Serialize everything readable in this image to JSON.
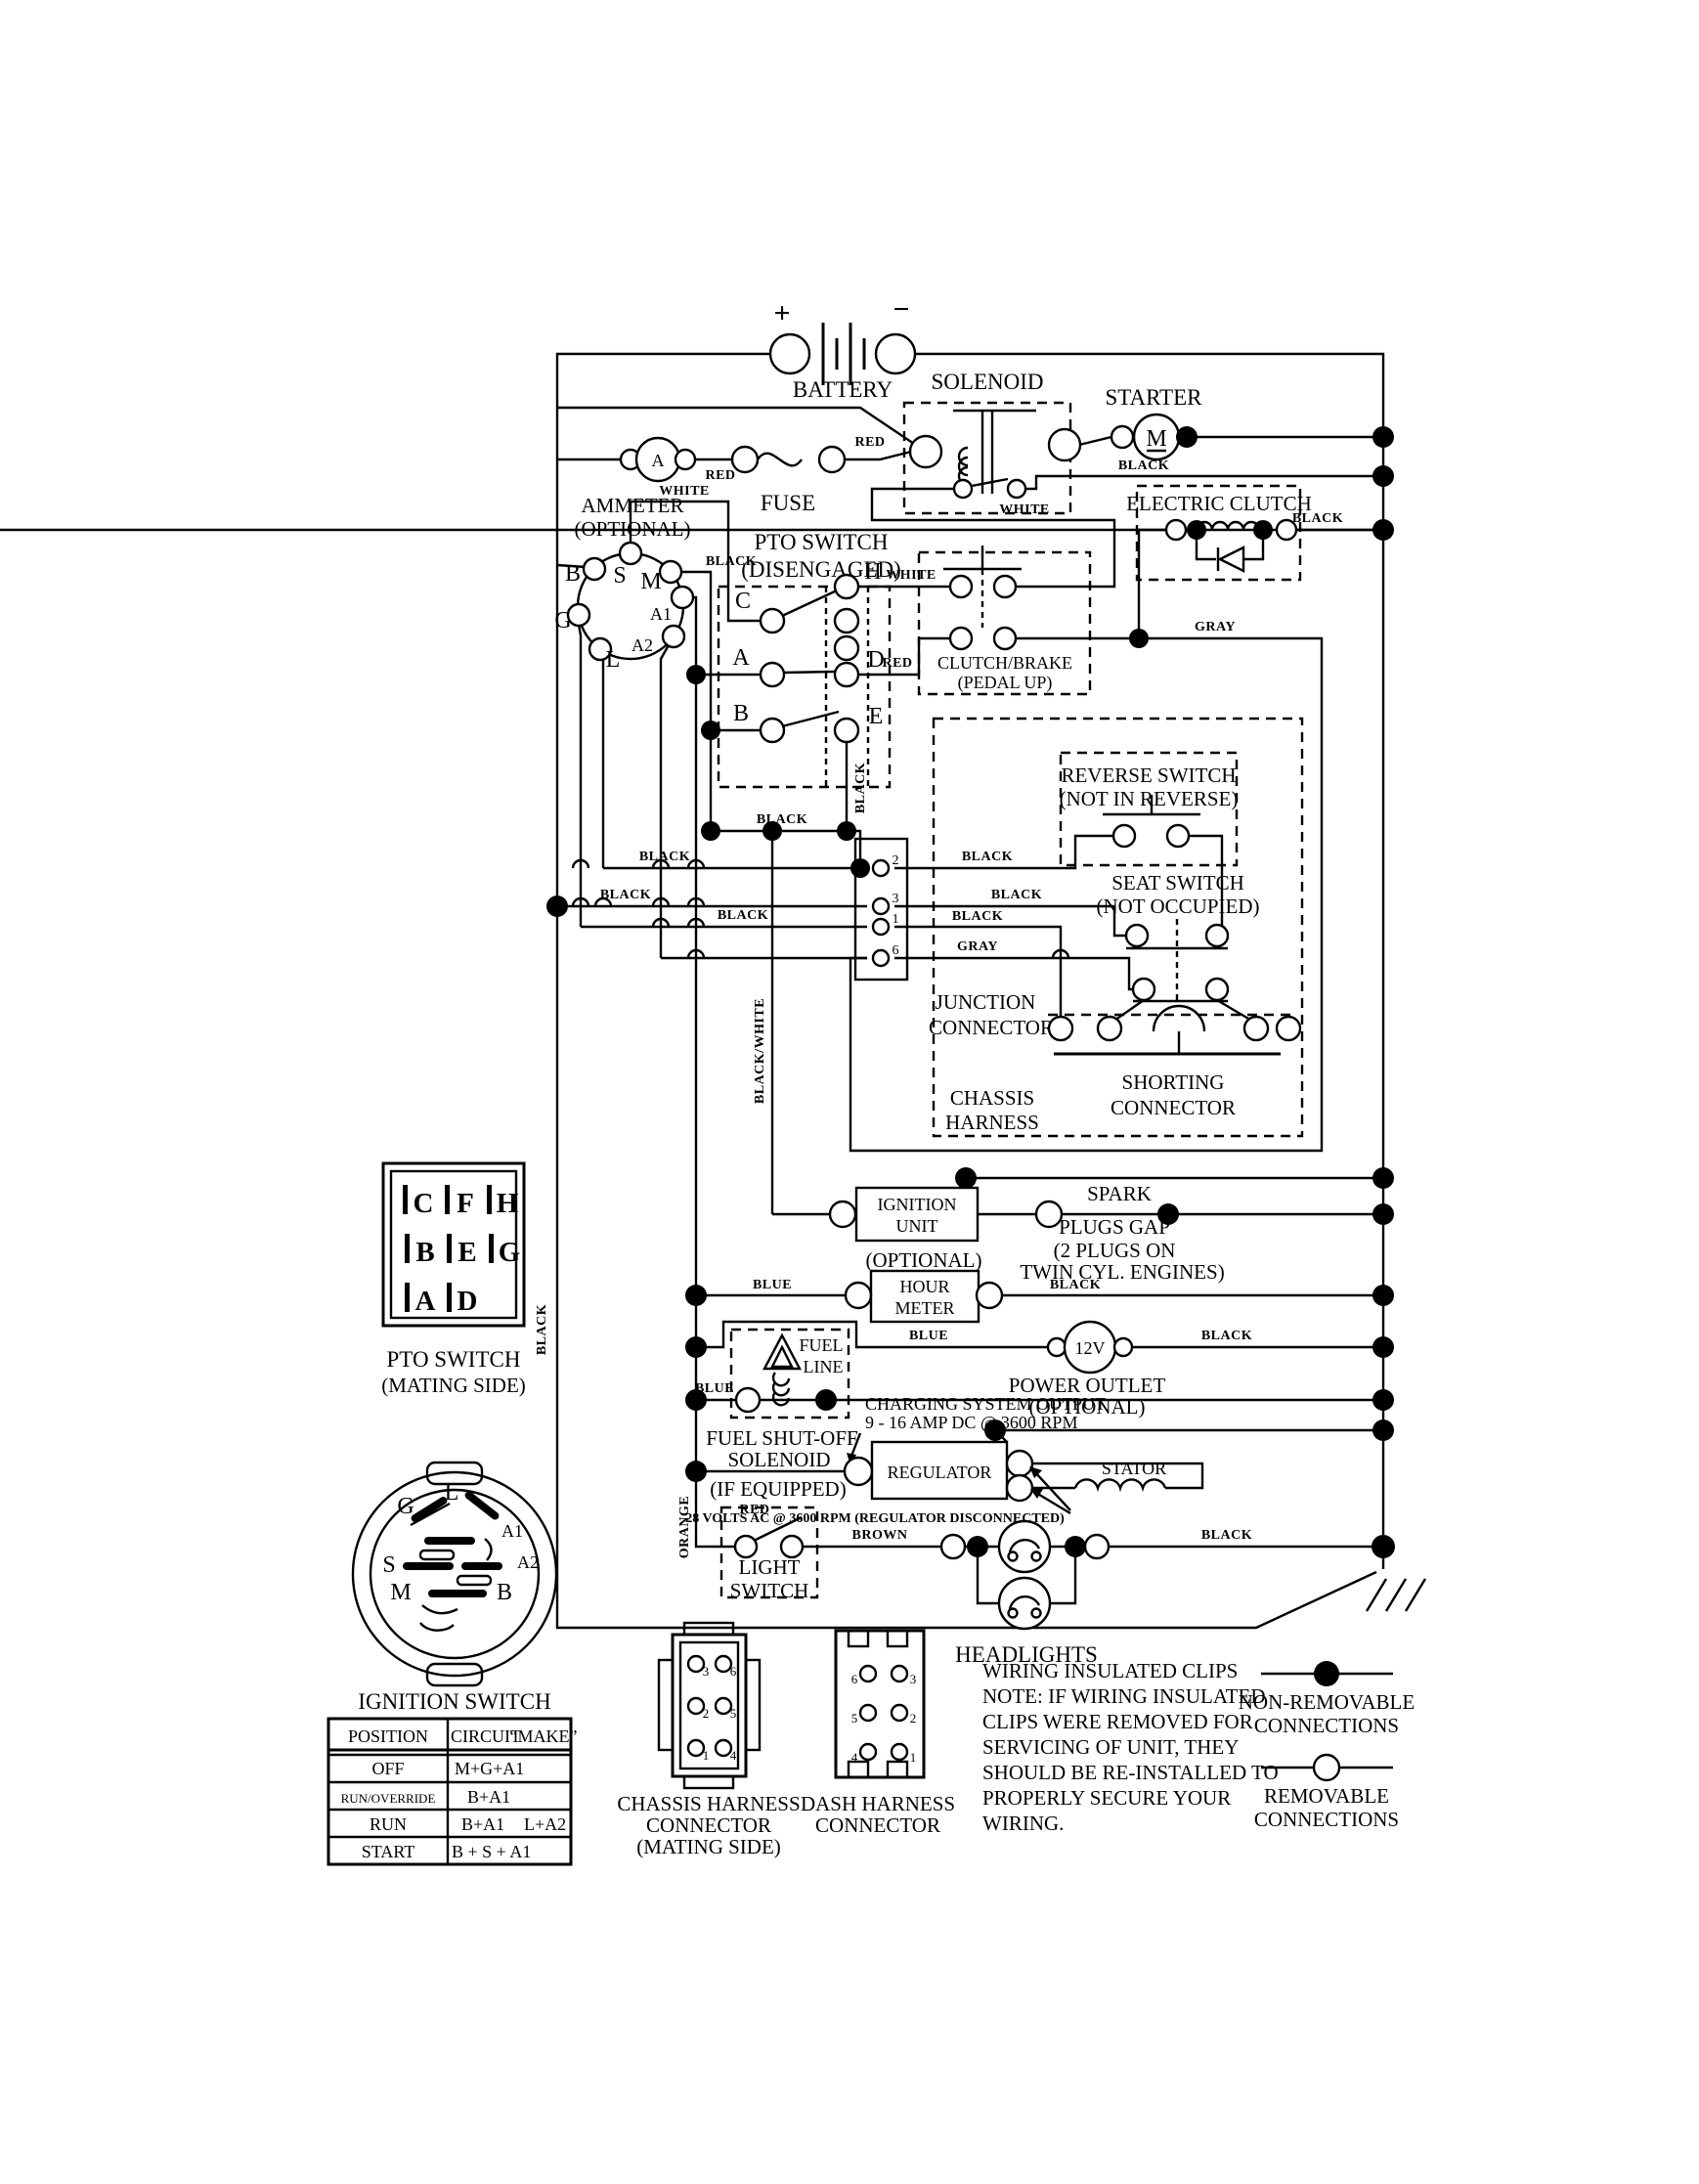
{
  "battery": {
    "plus": "+",
    "minus": "−",
    "label": "BATTERY"
  },
  "components": {
    "ammeter1": "AMMETER",
    "ammeter2": "(OPTIONAL)",
    "ammeter_symbol": "A",
    "fuse": "FUSE",
    "solenoid": "SOLENOID",
    "starter": "STARTER",
    "starter_symbol": "M",
    "electric_clutch": "ELECTRIC CLUTCH",
    "pto1": "PTO SWITCH",
    "pto2": "(DISENGAGED)",
    "clutch_brake1": "CLUTCH/BRAKE",
    "clutch_brake2": "(PEDAL UP)",
    "reverse1": "REVERSE SWITCH",
    "reverse2": "(NOT IN REVERSE)",
    "seat1": "SEAT SWITCH",
    "seat2": "(NOT OCCUPIED)",
    "junction1": "JUNCTION",
    "junction2": "CONNECTOR",
    "chassis1": "CHASSIS",
    "chassis2": "HARNESS",
    "shorting1": "SHORTING",
    "shorting2": "CONNECTOR",
    "ignition_unit1": "IGNITION",
    "ignition_unit2": "UNIT",
    "spark1": "SPARK",
    "spark2": "PLUGS GAP",
    "spark3": "(2 PLUGS ON",
    "spark4": "TWIN CYL. ENGINES)",
    "hour0": "(OPTIONAL)",
    "hour1": "HOUR",
    "hour2": "METER",
    "twelve_v": "12V",
    "outlet1": "POWER OUTLET",
    "outlet2": "(OPTIONAL)",
    "fuel1": "FUEL",
    "fuel2": "LINE",
    "fuel_shutoff1": "FUEL SHUT-OFF",
    "fuel_shutoff2": "SOLENOID",
    "fuel_shutoff3": "(IF EQUIPPED)",
    "charging1": "CHARGING SYSTEM OUTPUT",
    "charging2": "9 - 16 AMP DC @ 3600 RPM",
    "regulator": "REGULATOR",
    "stator": "STATOR",
    "volts_note": "28 VOLTS AC @ 3600 RPM (REGULATOR DISCONNECTED)",
    "light1": "LIGHT",
    "light2": "SWITCH",
    "headlights": "HEADLIGHTS"
  },
  "wire_labels": {
    "red1": "RED",
    "red2": "RED",
    "black_solenoid": "BLACK",
    "black_clutch": "BLACK",
    "white_s": "WHITE",
    "white_h": "WHITE",
    "white_return": "WHITE",
    "black_m": "BLACK",
    "red_a": "RED",
    "black_e": "BLACK",
    "black_850": "BLACK",
    "black_888": "BLACK",
    "black_927l": "BLACK",
    "black_948l": "BLACK",
    "black_pin2": "BLACK",
    "black_pin3": "BLACK",
    "black_pin1": "BLACK",
    "gray_pin6": "GRAY",
    "gray_main": "GRAY",
    "blue_hour": "BLUE",
    "black_hour": "BLACK",
    "blue_12v": "BLUE",
    "black_12v": "BLACK",
    "blue_fuel": "BLUE",
    "red_reg": "RED",
    "brown": "BROWN",
    "black_head": "BLACK",
    "black_bus": "BLACK",
    "black_white": "BLACK/WHITE",
    "orange": "ORANGE"
  },
  "pto_letters": {
    "c": "C",
    "a": "A",
    "b": "B",
    "h": "H",
    "d": "D",
    "e": "E"
  },
  "rosette": {
    "s": "S",
    "b": "B",
    "m": "M",
    "g": "G",
    "l": "L",
    "a1": "A1",
    "a2": "A2"
  },
  "junction_pins": [
    "2",
    "3",
    "1",
    "6"
  ],
  "pto_mating": {
    "title1": "PTO SWITCH",
    "title2": "(MATING SIDE)",
    "pins": [
      "C",
      "F",
      "H",
      "B",
      "E",
      "G",
      "A",
      "D"
    ]
  },
  "ignition_switch": {
    "title": "IGNITION SWITCH",
    "terminals": {
      "g": "G",
      "l": "L",
      "a1": "A1",
      "a2": "A2",
      "s": "S",
      "m": "M",
      "b": "B"
    }
  },
  "table": {
    "h1": "POSITION",
    "h2": "CIRCUIT",
    "h3": "“MAKE”",
    "rows": [
      [
        "OFF",
        "M+G+A1",
        ""
      ],
      [
        "RUN/OVERRIDE",
        "B+A1",
        ""
      ],
      [
        "RUN",
        "B+A1",
        "L+A2"
      ],
      [
        "START",
        "B + S + A1",
        ""
      ]
    ]
  },
  "connectors": {
    "chassis1": "CHASSIS HARNESS",
    "chassis2": "CONNECTOR",
    "chassis3": "(MATING SIDE)",
    "chassis_pins": [
      "3",
      "6",
      "2",
      "5",
      "1",
      "4"
    ],
    "dash1": "DASH HARNESS",
    "dash2": "CONNECTOR",
    "dash_pins": [
      "6",
      "3",
      "5",
      "2",
      "4",
      "1"
    ]
  },
  "note": [
    "WIRING INSULATED CLIPS",
    "NOTE:  IF WIRING INSULATED",
    "CLIPS WERE REMOVED FOR",
    "SERVICING OF UNIT, THEY",
    "SHOULD BE RE-INSTALLED TO",
    "PROPERLY SECURE YOUR",
    "WIRING."
  ],
  "legend": {
    "nr1": "NON-REMOVABLE",
    "nr2": "CONNECTIONS",
    "r1": "REMOVABLE",
    "r2": "CONNECTIONS"
  }
}
